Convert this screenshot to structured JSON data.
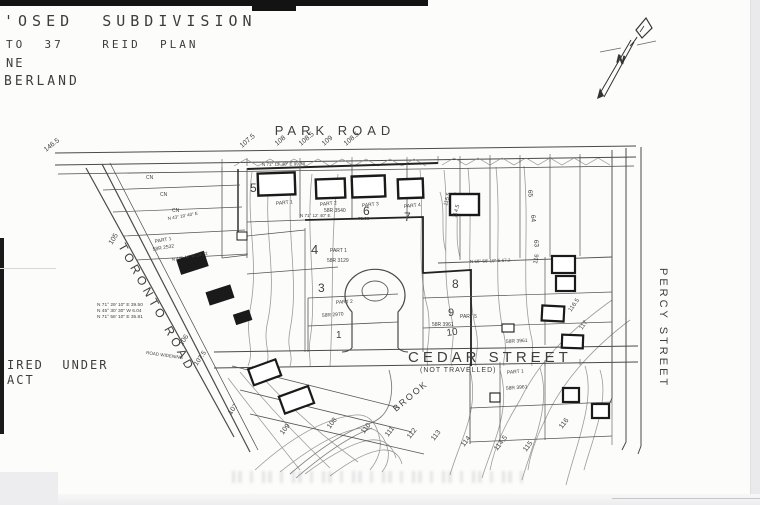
{
  "header": {
    "line1": "'OSED  SUBDIVISION",
    "line2": "TO  37    REID  PLAN",
    "line3": "NE",
    "line4": "BERLAND"
  },
  "note": {
    "line1": "IRED  UNDER",
    "line2": "ACT"
  },
  "compass": {
    "label": "N"
  },
  "roads": {
    "park": "PARK   ROAD",
    "toronto": "TORONTO  ROAD",
    "percy": "PERCY   STREET",
    "cedar": "CEDAR  STREET",
    "cedar_sub": "(NOT  TRAVELLED)",
    "widening": "ROAD  WIDENING",
    "brook": "BROOK"
  },
  "lots": {
    "l1": "1",
    "l3": "3",
    "l4": "4",
    "l5": "5",
    "l6": "6",
    "l7": "7",
    "l8": "8",
    "l9": "9",
    "l10": "10"
  },
  "parts": {
    "p1": "PART 1",
    "p2": "PART 2",
    "p3": "PART 3",
    "p4": "PART 4",
    "p5": "PART 5"
  },
  "plan_refs": {
    "r2532": "58R 2532",
    "r2970": "58R 2970",
    "r3961": "58R 3961",
    "r3540": "58R 3540",
    "r3129": "58R 3129"
  },
  "bearings": {
    "top": "N 71° 12' 40\" E  99.78",
    "mid": "N 71° 12' 40\" E",
    "mid_d": "78.08",
    "right": "N 68° 58' 10\" E  67.2",
    "nw1": "N 43° 10' 40\" E",
    "nw2": "N 44° 44' W  24.72",
    "t1": "N 71° 29' 10\" E   39.50",
    "t2": "N 45° 30' 30\" W    6.04",
    "t3": "N 71° 58' 10\" E   35.81"
  },
  "contours": {
    "a146": "146.5",
    "a1075": "107.5",
    "a108": "108",
    "a1085": "108.5",
    "a109": "109",
    "a1085b": "108.5",
    "m105": "105",
    "m106": "106",
    "m1075": "107.5",
    "b107": "107",
    "b108": "108",
    "b109": "109",
    "b110": "110",
    "b111": "111",
    "b112": "112",
    "b113": "113",
    "b114": "114",
    "b1145": "114.5",
    "b115": "115",
    "b116": "116",
    "r1165": "116.5",
    "r117": "117",
    "r116": "116",
    "r1155": "115.5",
    "r1145": "114.5"
  },
  "elev": {
    "e1": "65",
    "e2": "64",
    "e3": "63"
  },
  "misc": {
    "cn": "CN"
  }
}
